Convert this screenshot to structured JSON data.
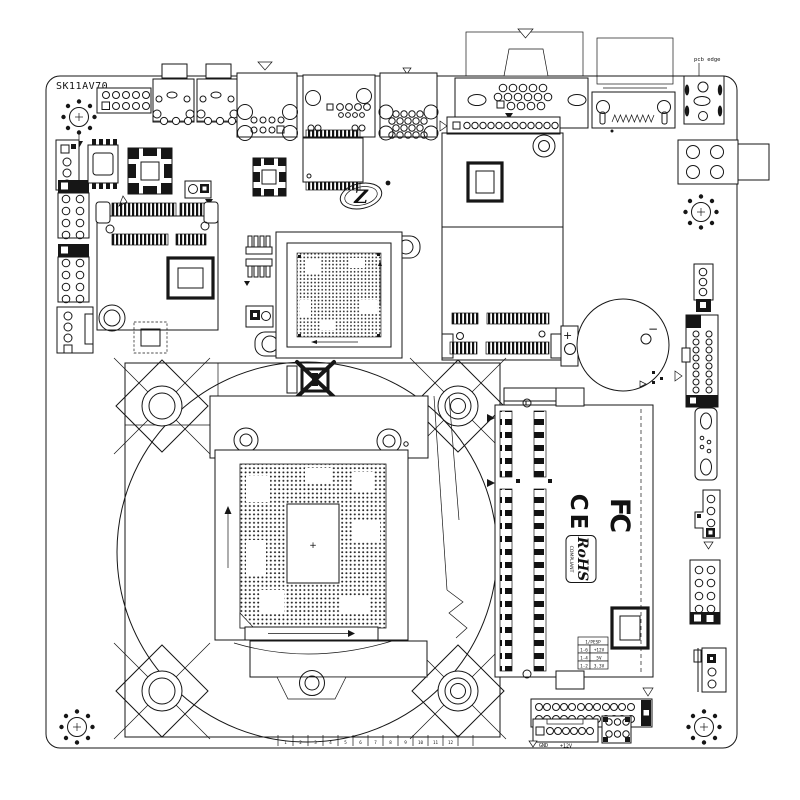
{
  "diagram": {
    "board_model": "SK11AV70",
    "pcb_edge_label": "pcb edge",
    "logo_letter": "Z",
    "cert_fc": "FC",
    "cert_ce": "CE",
    "cert_rohs": "RoHS",
    "cert_rohs_sub": "COMPLIANT",
    "battery_plus": "+",
    "battery_minus": "−",
    "socket_center_mark": "+",
    "gnd_label": "GND",
    "v12_label": "+12V",
    "voltage_table": {
      "header": "1/PESP",
      "rows": [
        {
          "pins": "1-6",
          "voltage": "+12V"
        },
        {
          "pins": "1-4",
          "voltage": "5V"
        },
        {
          "pins": "1-2",
          "voltage": "3.3V"
        }
      ]
    },
    "ruler_ticks": [
      "1",
      "2",
      "3",
      "4",
      "5",
      "6",
      "7",
      "8",
      "9",
      "10",
      "11",
      "12"
    ]
  }
}
